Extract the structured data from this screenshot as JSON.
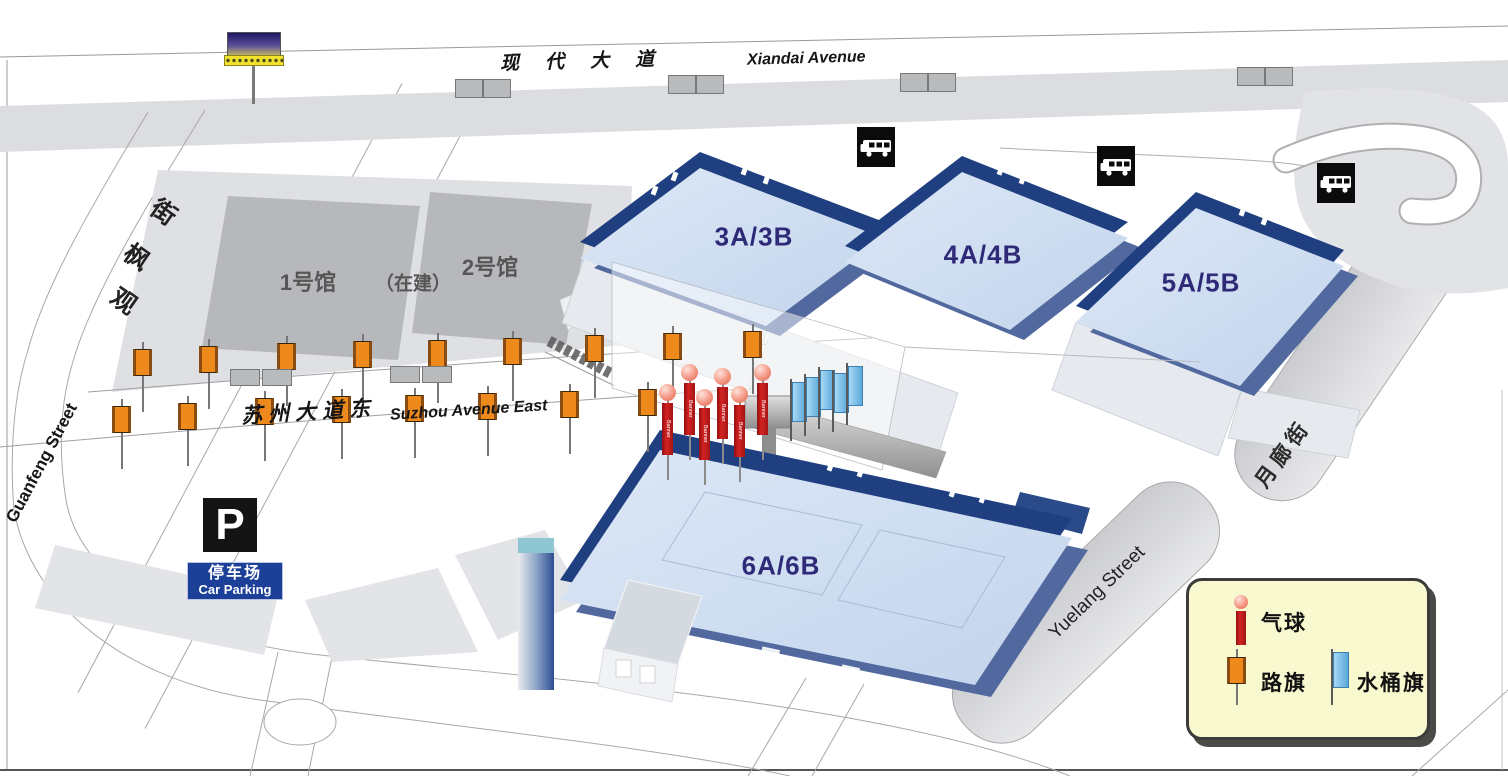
{
  "map": {
    "roads": {
      "xiandai": {
        "cn": "现代大道",
        "en": "Xiandai Avenue"
      },
      "suzhou": {
        "cn": "苏州大道东",
        "en": "Suzhou Avenue East"
      },
      "guanfeng": {
        "cn": "观枫街",
        "en": "Guanfeng Street"
      },
      "yuelang": {
        "cn": "月廊街",
        "en": "Yuelang Street"
      }
    },
    "buildings": {
      "hall1": "1号馆",
      "under_construction": "（在建）",
      "hall2": "2号馆",
      "hall3": "3A/3B",
      "hall4": "4A/4B",
      "hall5": "5A/5B",
      "hall6": "6A/6B"
    },
    "parking": {
      "symbol": "P",
      "cn": "停车场",
      "en": "Car Parking"
    },
    "banner_text": "Banner",
    "legend": {
      "items": [
        {
          "icon": "balloon-banner-icon",
          "label": "气球"
        },
        {
          "icon": "road-flag-icon",
          "label": "路旗"
        },
        {
          "icon": "bucket-flag-icon",
          "label": "水桶旗"
        }
      ]
    },
    "colors": {
      "hall_roof": "#cddcf0",
      "hall_wall": "#1f3f80",
      "hall_label": "#2e2a78",
      "road_flag": "#ee8a1c",
      "bucket_flag": "#79c0e8",
      "balloon": "#f2907c",
      "banner_red": "#c41f1f",
      "legend_bg": "#f9f9cf",
      "parking_blue": "#1c3f97"
    },
    "decorations": {
      "road_flags_upper": [
        [
          143,
          350
        ],
        [
          209,
          347
        ],
        [
          287,
          344
        ],
        [
          363,
          342
        ],
        [
          438,
          341
        ],
        [
          513,
          339
        ],
        [
          595,
          336
        ],
        [
          673,
          334
        ],
        [
          753,
          332
        ]
      ],
      "road_flags_lower": [
        [
          122,
          407
        ],
        [
          188,
          404
        ],
        [
          265,
          399
        ],
        [
          342,
          397
        ],
        [
          415,
          396
        ],
        [
          488,
          394
        ],
        [
          570,
          392
        ],
        [
          648,
          390
        ]
      ],
      "balloons": [
        [
          668,
          393
        ],
        [
          690,
          373
        ],
        [
          705,
          398
        ],
        [
          723,
          377
        ],
        [
          740,
          395
        ],
        [
          763,
          373
        ]
      ],
      "bucket_flags": [
        [
          792,
          383
        ],
        [
          806,
          378
        ],
        [
          820,
          371
        ],
        [
          834,
          374
        ],
        [
          848,
          367
        ]
      ],
      "bus_stops": [
        [
          857,
          127
        ],
        [
          1097,
          146
        ],
        [
          1317,
          163
        ]
      ],
      "bus_shelters_top": [
        [
          455,
          79
        ],
        [
          483,
          79
        ],
        [
          668,
          75
        ],
        [
          696,
          75
        ],
        [
          900,
          73
        ],
        [
          928,
          73
        ],
        [
          1237,
          67
        ],
        [
          1265,
          67
        ]
      ],
      "bus_shelters_plaza": [
        [
          230,
          369
        ],
        [
          262,
          369
        ],
        [
          390,
          366
        ],
        [
          422,
          366
        ]
      ]
    }
  }
}
